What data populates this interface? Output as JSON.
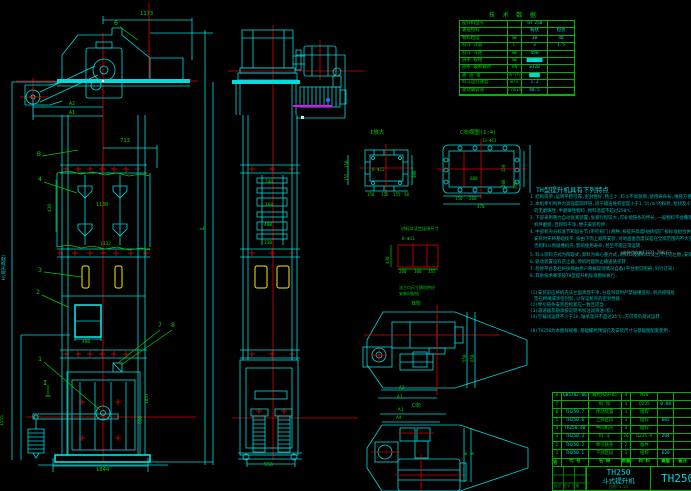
{
  "drawing": {
    "model": "TH250",
    "product_name": "斗式提升机"
  },
  "tech_table": {
    "title": "技 术 数 据",
    "rows": [
      {
        "lab": "提升机型号",
        "unit": "",
        "v1": "TH 250",
        "v2": ""
      },
      {
        "lab": "输送物料",
        "unit": "",
        "v1": "粉状",
        "v2": "粒状"
      },
      {
        "lab": "物料粒度",
        "unit": "mm",
        "v1": "30",
        "v2": "40"
      },
      {
        "lab": "料斗 斗容",
        "unit": "L",
        "v1": "3",
        "v2": "1.5"
      },
      {
        "lab": "料斗 斗距",
        "unit": "mm",
        "v1": "450",
        "v2": ""
      },
      {
        "lab": "链条 规格",
        "unit": "mm",
        "v1": "██████",
        "v2": ""
      },
      {
        "lab": "链条 破断载荷",
        "unit": "kN",
        "v1": "≥320",
        "v2": ""
      },
      {
        "lab": "输 送 量",
        "unit": "m³/h",
        "v1": "████",
        "v2": ""
      },
      {
        "lab": "料斗运行速度",
        "unit": "m/s",
        "v1": "1.2",
        "v2": ""
      },
      {
        "lab": "驱动轴转速",
        "unit": "r/min",
        "v1": "48.5",
        "v2": ""
      }
    ]
  },
  "notes": {
    "header": "TH型提升机具有下列特点",
    "lines": [
      {
        "t": "1.结构简单,运转平稳可靠,密封性好,扬尘少,料斗不易脱落,使用寿命长,维修方便等一系列优点.",
        "x": 530,
        "y": 196
      },
      {
        "t": "2.本机牵引构件为高强度圆环链,适于输送堆积密度小于1.5t/m³的粉状,粒状及小块状",
        "x": 530,
        "y": 203
      },
      {
        "t": "的无磨琢性,半磨琢性物料,物料温度不超过250℃.",
        "x": 534,
        "y": 210
      },
      {
        "t": "3.下部采用重力自动张紧装置,张紧行程较大,可补偿链条的伸长,一般物料不会撒落,减少了",
        "x": 530,
        "y": 217
      },
      {
        "t": "机件磨损,且卸料干净,便于安装检修.",
        "x": 534,
        "y": 224
      },
      {
        "t": "4.中部机壳分标准节和加长节(带检视门)两种,按提升高度H由制造厂按标准组合供货,机壳",
        "x": 530,
        "y": 231
      },
      {
        "t": "安装时先将基础找平,按由下而上顺序安装,对地面垂直度误差在全高范围内不大于10mm,",
        "x": 534,
        "y": 238
      },
      {
        "t": "否则料斗易碰撞机壳,影响使用寿命,甚至不能正常运转.",
        "x": 534,
        "y": 245
      },
      {
        "t": "5.料斗装料方式为掏取式,卸料为离心重力式,进料口及卸料口法兰尺寸见左图,安装时配钻.",
        "x": 530,
        "y": 254
      },
      {
        "t": "6.驱动装置设有逆止器,停机时能防止输送链逆转.",
        "x": 530,
        "y": 261
      },
      {
        "t": "7.检修平台及栏杆扶梯由用户根据现场情况自备(平台图见图册,另行订货).",
        "x": 530,
        "y": 268
      },
      {
        "t": "8.其余技术要求按TH型提升机标准图样执行.",
        "x": 530,
        "y": 275
      },
      {
        "t": "(1)安装前应将机壳法兰面清理干净,分段吊装时严禁碰撞变形,机壳接缝处",
        "x": 530,
        "y": 292
      },
      {
        "t": "垫石棉绳或涂密封胶,以保证机壳的密封性能.",
        "x": 534,
        "y": 298
      },
      {
        "t": "(2)牵引链条安装后松紧应一致且适当.",
        "x": 530,
        "y": 304
      },
      {
        "t": "(3)减速器及轴承按说明书加注润滑油(脂).",
        "x": 530,
        "y": 310
      },
      {
        "t": "(4)空载试运转不少于2h,轴承温升不超过25℃,方可带负荷试运转.",
        "x": 530,
        "y": 316
      },
      {
        "t": "(8)TH250为本图样规格,基础螺栓预留孔及安装尺寸与基础图配套使用.",
        "x": 530,
        "y": 330
      }
    ]
  },
  "labels": [
    {
      "t": "1173",
      "x": 140,
      "y": 12,
      "c": "g",
      "s": 5.5
    },
    {
      "t": "6",
      "x": 114,
      "y": 20,
      "c": "g",
      "s": 6.5
    },
    {
      "t": "A2",
      "x": 69,
      "y": 102,
      "c": "g",
      "s": 5
    },
    {
      "t": "A1",
      "x": 69,
      "y": 111,
      "c": "g",
      "s": 5
    },
    {
      "t": "713",
      "x": 120,
      "y": 139,
      "c": "g",
      "s": 5.5
    },
    {
      "t": "B",
      "x": 37,
      "y": 151,
      "c": "g",
      "s": 6.5
    },
    {
      "t": "4",
      "x": 38,
      "y": 176,
      "c": "g",
      "s": 6.5
    },
    {
      "t": "430",
      "x": 49,
      "y": 212,
      "c": "g",
      "s": 4.5,
      "r": -90
    },
    {
      "t": "1130",
      "x": 96,
      "y": 203,
      "c": "g",
      "s": 5
    },
    {
      "t": "1332",
      "x": 100,
      "y": 243,
      "c": "g",
      "s": 4.5
    },
    {
      "t": "3",
      "x": 38,
      "y": 267,
      "c": "g",
      "s": 6.5
    },
    {
      "t": "2",
      "x": 36,
      "y": 289,
      "c": "g",
      "s": 6.5
    },
    {
      "t": "480",
      "x": 82,
      "y": 341,
      "c": "g",
      "s": 4.5
    },
    {
      "t": "7",
      "x": 158,
      "y": 322,
      "c": "g",
      "s": 6.5
    },
    {
      "t": "8",
      "x": 171,
      "y": 322,
      "c": "g",
      "s": 6.5
    },
    {
      "t": "1",
      "x": 38,
      "y": 356,
      "c": "g",
      "s": 6.5
    },
    {
      "t": "I",
      "x": 43,
      "y": 380,
      "c": "g",
      "s": 7
    },
    {
      "t": "H(提升高度)",
      "x": 3,
      "y": 280,
      "c": "c",
      "s": 4.5,
      "r": -90
    },
    {
      "t": "1555",
      "x": 1,
      "y": 426,
      "c": "g",
      "s": 4.5,
      "r": -90
    },
    {
      "t": "1857",
      "x": 146,
      "y": 404,
      "c": "g",
      "s": 4.5,
      "r": -90
    },
    {
      "t": "550",
      "x": 140,
      "y": 424,
      "c": "g",
      "s": 4.5,
      "r": -90
    },
    {
      "t": "1844",
      "x": 96,
      "y": 468,
      "c": "g",
      "s": 5.5
    },
    {
      "t": "L",
      "x": 199,
      "y": 230,
      "c": "g",
      "s": 6.5,
      "r": -90
    },
    {
      "t": "240",
      "x": 265,
      "y": 181,
      "c": "g",
      "s": 4.5
    },
    {
      "t": "160",
      "x": 265,
      "y": 204,
      "c": "g",
      "s": 4.5
    },
    {
      "t": "400",
      "x": 264,
      "y": 224,
      "c": "g",
      "s": 4.5
    },
    {
      "t": "330",
      "x": 264,
      "y": 242,
      "c": "g",
      "s": 4.5
    },
    {
      "t": "556",
      "x": 264,
      "y": 463,
      "c": "g",
      "s": 5
    },
    {
      "t": "I放大",
      "x": 370,
      "y": 131,
      "c": "g",
      "s": 5.5
    },
    {
      "t": "8-Φ12",
      "x": 372,
      "y": 168,
      "c": "g",
      "s": 4.2
    },
    {
      "t": "150",
      "x": 345,
      "y": 168,
      "c": "g",
      "s": 4.2,
      "r": -90
    },
    {
      "t": "155",
      "x": 345,
      "y": 181,
      "c": "g",
      "s": 4.2,
      "r": -90
    },
    {
      "t": "300",
      "x": 413,
      "y": 178,
      "c": "g",
      "s": 4.2,
      "r": -90
    },
    {
      "t": "150",
      "x": 367,
      "y": 193,
      "c": "g",
      "s": 4.2
    },
    {
      "t": "155",
      "x": 381,
      "y": 193,
      "c": "g",
      "s": 4.2
    },
    {
      "t": "155",
      "x": 393,
      "y": 193,
      "c": "g",
      "s": 4.2
    },
    {
      "t": "30",
      "x": 404,
      "y": 193,
      "c": "g",
      "s": 4.2
    },
    {
      "t": "C向视图(1:4)",
      "x": 460,
      "y": 131,
      "c": "g",
      "s": 5.5
    },
    {
      "t": "13-Φ11",
      "x": 482,
      "y": 139,
      "c": "g",
      "s": 4
    },
    {
      "t": "600",
      "x": 470,
      "y": 177,
      "c": "g",
      "s": 4.2
    },
    {
      "t": "150",
      "x": 502,
      "y": 172,
      "c": "g",
      "s": 4.2,
      "r": -90
    },
    {
      "t": "200",
      "x": 502,
      "y": 187,
      "c": "g",
      "s": 4.2,
      "r": -90
    },
    {
      "t": "320",
      "x": 514,
      "y": 189,
      "c": "g",
      "s": 4.2,
      "r": -90
    },
    {
      "t": "150",
      "x": 455,
      "y": 197,
      "c": "g",
      "s": 4.2
    },
    {
      "t": "200",
      "x": 469,
      "y": 197,
      "c": "g",
      "s": 4.2
    },
    {
      "t": "470",
      "x": 477,
      "y": 205,
      "c": "g",
      "s": 4.2
    },
    {
      "t": "进料口法兰连接尺寸",
      "x": 401,
      "y": 227,
      "c": "g",
      "s": 4.2
    },
    {
      "t": "8-Φ11",
      "x": 402,
      "y": 237,
      "c": "g",
      "s": 4.2
    },
    {
      "t": "430",
      "x": 386,
      "y": 264,
      "c": "g",
      "s": 4.2,
      "r": -90
    },
    {
      "t": "200",
      "x": 399,
      "y": 270,
      "c": "g",
      "s": 4.2
    },
    {
      "t": "300",
      "x": 414,
      "y": 270,
      "c": "g",
      "s": 4.2
    },
    {
      "t": "155",
      "x": 428,
      "y": 270,
      "c": "g",
      "s": 4.2
    },
    {
      "t": "法兰口尺寸随机供应",
      "x": 399,
      "y": 286,
      "c": "g",
      "s": 4
    },
    {
      "t": "安装时配钻",
      "x": 399,
      "y": 292,
      "c": "g",
      "s": 4
    },
    {
      "t": "B向",
      "x": 412,
      "y": 302,
      "c": "g",
      "s": 5.5
    },
    {
      "t": "A2",
      "x": 399,
      "y": 387,
      "c": "g",
      "s": 4.5
    },
    {
      "t": "A1",
      "x": 397,
      "y": 396,
      "c": "g",
      "s": 4.5
    },
    {
      "t": "550",
      "x": 463,
      "y": 362,
      "c": "g",
      "s": 4.2,
      "r": -90
    },
    {
      "t": "650",
      "x": 471,
      "y": 362,
      "c": "g",
      "s": 4.2,
      "r": -90
    },
    {
      "t": "C向",
      "x": 412,
      "y": 404,
      "c": "g",
      "s": 5.5
    },
    {
      "t": "A1",
      "x": 398,
      "y": 409,
      "c": "g",
      "s": 4.5
    },
    {
      "t": "A4",
      "x": 396,
      "y": 417,
      "c": "g",
      "s": 4.5
    },
    {
      "t": "B",
      "x": 465,
      "y": 455,
      "c": "g",
      "s": 4.5,
      "r": -90
    },
    {
      "t": "a",
      "x": 472,
      "y": 455,
      "c": "g",
      "s": 4.5,
      "r": -90
    },
    {
      "t": "(安装验收按TJ231-78执行)",
      "x": 620,
      "y": 251,
      "c": "gr",
      "s": 4
    }
  ],
  "parts_list": {
    "header": {
      "no": "件号",
      "code": "代  号",
      "name": "名  称",
      "qty": "数量",
      "mat": "材  料",
      "wt": "重量",
      "rem": "备注"
    },
    "rows": [
      {
        "no": "8",
        "code": "GB5782-86",
        "name": "螺栓M20×85",
        "qty": "4",
        "mat": "M20",
        "wt": "",
        "rem": ""
      },
      {
        "no": "7",
        "code": "",
        "name": "机  架",
        "qty": "1",
        "mat": "Q235",
        "wt": "0.08",
        "rem": ""
      },
      {
        "no": "6",
        "code": "TH250.7",
        "name": "传动装置",
        "qty": "1",
        "mat": "组焊",
        "wt": "",
        "rem": ""
      },
      {
        "no": "5",
        "code": "TH250.6",
        "name": "上部区段",
        "qty": "1",
        "mat": "组焊",
        "wt": "605",
        "rem": ""
      },
      {
        "no": "4",
        "code": "TH250.4B",
        "name": "中间机壳",
        "qty": "4",
        "mat": "组焊",
        "wt": "",
        "rem": ""
      },
      {
        "no": "3",
        "code": "TH250.3",
        "name": "料  斗",
        "qty": "26",
        "mat": "Q235-A",
        "wt": "204",
        "rem": ""
      },
      {
        "no": "2",
        "code": "TH250.2",
        "name": "牵引链条",
        "qty": "2",
        "mat": "备件",
        "wt": "",
        "rem": ""
      },
      {
        "no": "1",
        "code": "TH250.1",
        "name": "下部区段",
        "qty": "1",
        "mat": "组焊",
        "wt": "620",
        "rem": ""
      }
    ]
  },
  "title_block": {
    "model": "TH250",
    "name": "斗式提升机",
    "scale": "比例 1:25",
    "drawing_no": "TH250",
    "left_note": "标记 签字 日期"
  }
}
